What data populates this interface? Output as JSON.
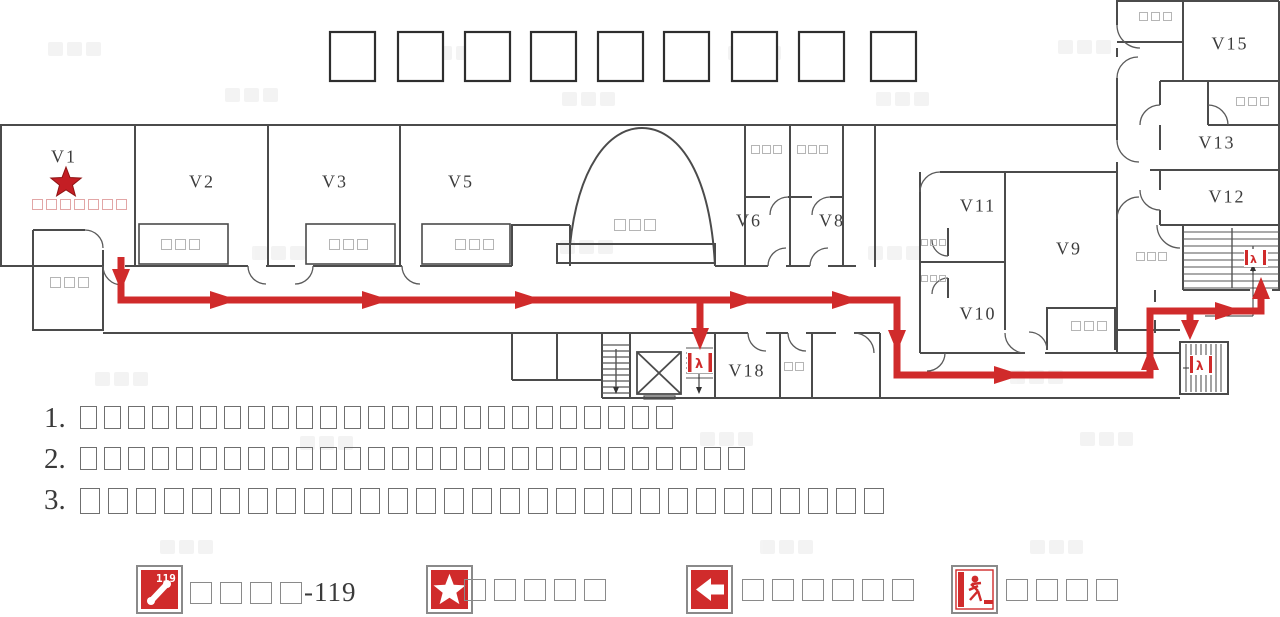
{
  "plan": {
    "room_labels": {
      "v1": "V1",
      "v2": "V2",
      "v3": "V3",
      "v5": "V5",
      "v6": "V6",
      "v8": "V8",
      "v9": "V9",
      "v10": "V10",
      "v11": "V11",
      "v12": "V12",
      "v13": "V13",
      "v15": "V15",
      "v18": "V18"
    },
    "sign_boxes": {
      "v1_sign": 7,
      "entrance": 3,
      "v2_table": 3,
      "v3_table": 3,
      "v5_table": 3,
      "lobby": 3,
      "v6_top": 3,
      "v8_top": 3,
      "v11_side": 3,
      "v10_side": 3,
      "v9_closet": 3,
      "wing_corridor": 3,
      "v18_right": 2,
      "wing_top_room": 3,
      "v13_room": 3
    },
    "exit_sign_glyph": "λ"
  },
  "colors": {
    "route": "#d02b2b",
    "star": "#c41e24",
    "wall": "#4b4b4b",
    "pink_sign": "#e2a6a6"
  },
  "notes": [
    {
      "num": "1.",
      "box_count": 25
    },
    {
      "num": "2.",
      "box_count": 28
    },
    {
      "num": "3.",
      "box_count": 29
    }
  ],
  "legend": {
    "items": [
      {
        "icon": "fire-phone",
        "icon_text": "119",
        "box_count": 4,
        "suffix": "-119"
      },
      {
        "icon": "location-star",
        "box_count": 5,
        "suffix": ""
      },
      {
        "icon": "evacuation-direction",
        "box_count": 6,
        "suffix": ""
      },
      {
        "icon": "safety-exit",
        "box_count": 4,
        "suffix": ""
      }
    ]
  }
}
